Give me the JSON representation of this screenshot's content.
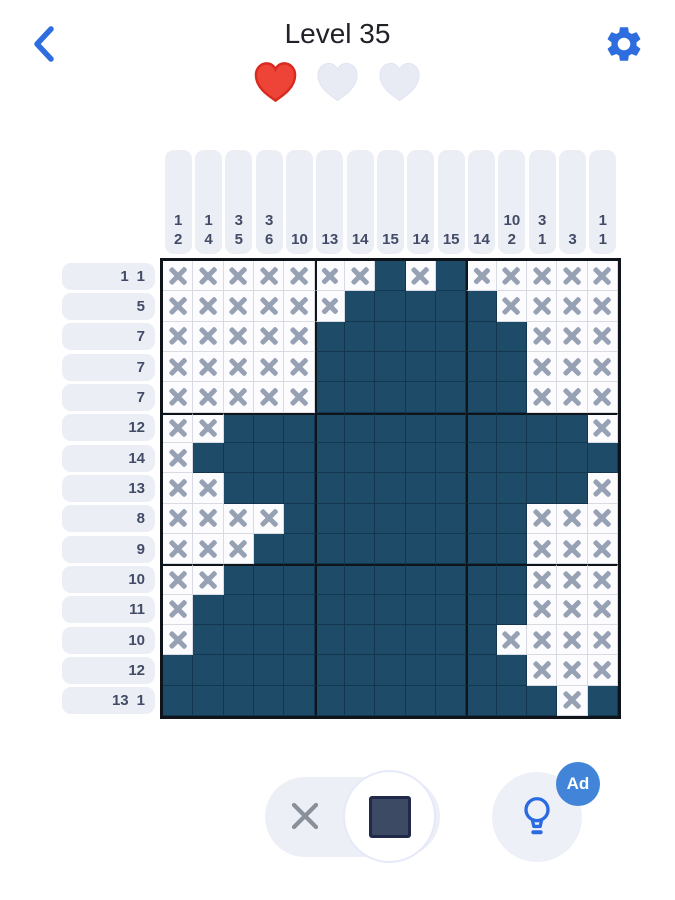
{
  "header": {
    "title": "Level 35"
  },
  "lives": {
    "total": 3,
    "remaining": 1,
    "hearts": [
      "red",
      "empty",
      "empty"
    ]
  },
  "board": {
    "size": 15,
    "column_clues": [
      [
        1,
        2
      ],
      [
        1,
        4
      ],
      [
        3,
        5
      ],
      [
        3,
        6
      ],
      [
        10
      ],
      [
        13
      ],
      [
        14
      ],
      [
        15
      ],
      [
        14
      ],
      [
        15
      ],
      [
        14
      ],
      [
        10,
        2
      ],
      [
        3,
        1
      ],
      [
        3
      ],
      [
        1,
        1
      ]
    ],
    "row_clues": [
      [
        1,
        1
      ],
      [
        5
      ],
      [
        7
      ],
      [
        7
      ],
      [
        7
      ],
      [
        12
      ],
      [
        14
      ],
      [
        13
      ],
      [
        8
      ],
      [
        9
      ],
      [
        10
      ],
      [
        11
      ],
      [
        10
      ],
      [
        12
      ],
      [
        13,
        1
      ]
    ],
    "cells": [
      "XXXXXXXFXFXXXXX",
      "XXXXXXFFFFFXXXX",
      "XXXXXFFFFFFFXXX",
      "XXXXXFFFFFFFXXX",
      "XXXXXFFFFFFFXXX",
      "XXFFFFFFFFFFFFX",
      "XFFFFFFFFFFFFFF",
      "XXFFFFFFFFFFFFX",
      "XXXXFFFFFFFFXXX",
      "XXXFFFFFFFFFXXX",
      "XXFFFFFFFFFFXXX",
      "XFFFFFFFFFFFXXX",
      "XFFFFFFFFFFXXXX",
      "FFFFFFFFFFFFXXX",
      "FFFFFFFFFFFFFXF"
    ],
    "legend": {
      "F": "filled",
      "X": "crossed"
    }
  },
  "toolbar": {
    "selected_mode": "fill",
    "modes": [
      "cross",
      "fill"
    ],
    "hint_badge": "Ad"
  },
  "colors": {
    "accent_blue": "#2e6ddf",
    "filled_cell": "#1e4b68",
    "cross_mark": "#97a1b4",
    "clue_pill_bg": "#eceef6",
    "clue_text": "#424c66",
    "heart_red": "#ee4438",
    "heart_empty": "#e8ebf4",
    "toggle_square": "#3d4a63",
    "ad_badge_bg": "#4285d8"
  }
}
